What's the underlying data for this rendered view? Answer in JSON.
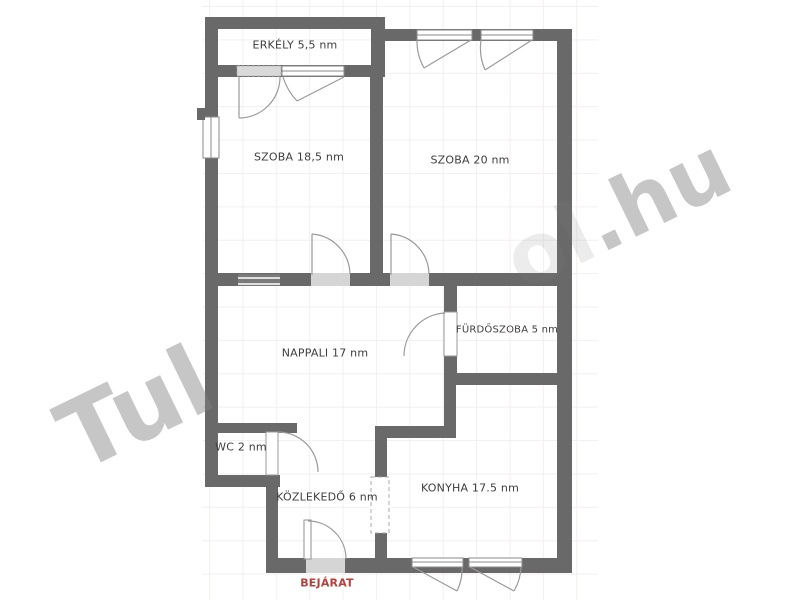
{
  "watermark": {
    "tul": "Tul",
    "ol": "ol",
    "hu": ".hu"
  },
  "labels": {
    "erkely": "ERKÉLY 5,5 nm",
    "szoba1": "SZOBA 18,5 nm",
    "szoba2": "SZOBA 20 nm",
    "nappali": "NAPPALI 17 nm",
    "furdoszoba": "FÜRDŐSZOBA 5 nm",
    "wc": "WC 2 nm",
    "kozlekedo": "KÖZLEKEDŐ 6 nm",
    "konyha": "KONYHA 17.5 nm",
    "bejarat": "BEJÁRAT"
  },
  "colors": {
    "wall": "#696969",
    "door_gap_fill": "#d5d5d5",
    "door_arc": "#9a9a9a",
    "entrance_text": "#b5403c",
    "grid_line": "#f3efee",
    "label_text": "#3d3d3d",
    "watermark_gray": "#c7c7c7"
  }
}
